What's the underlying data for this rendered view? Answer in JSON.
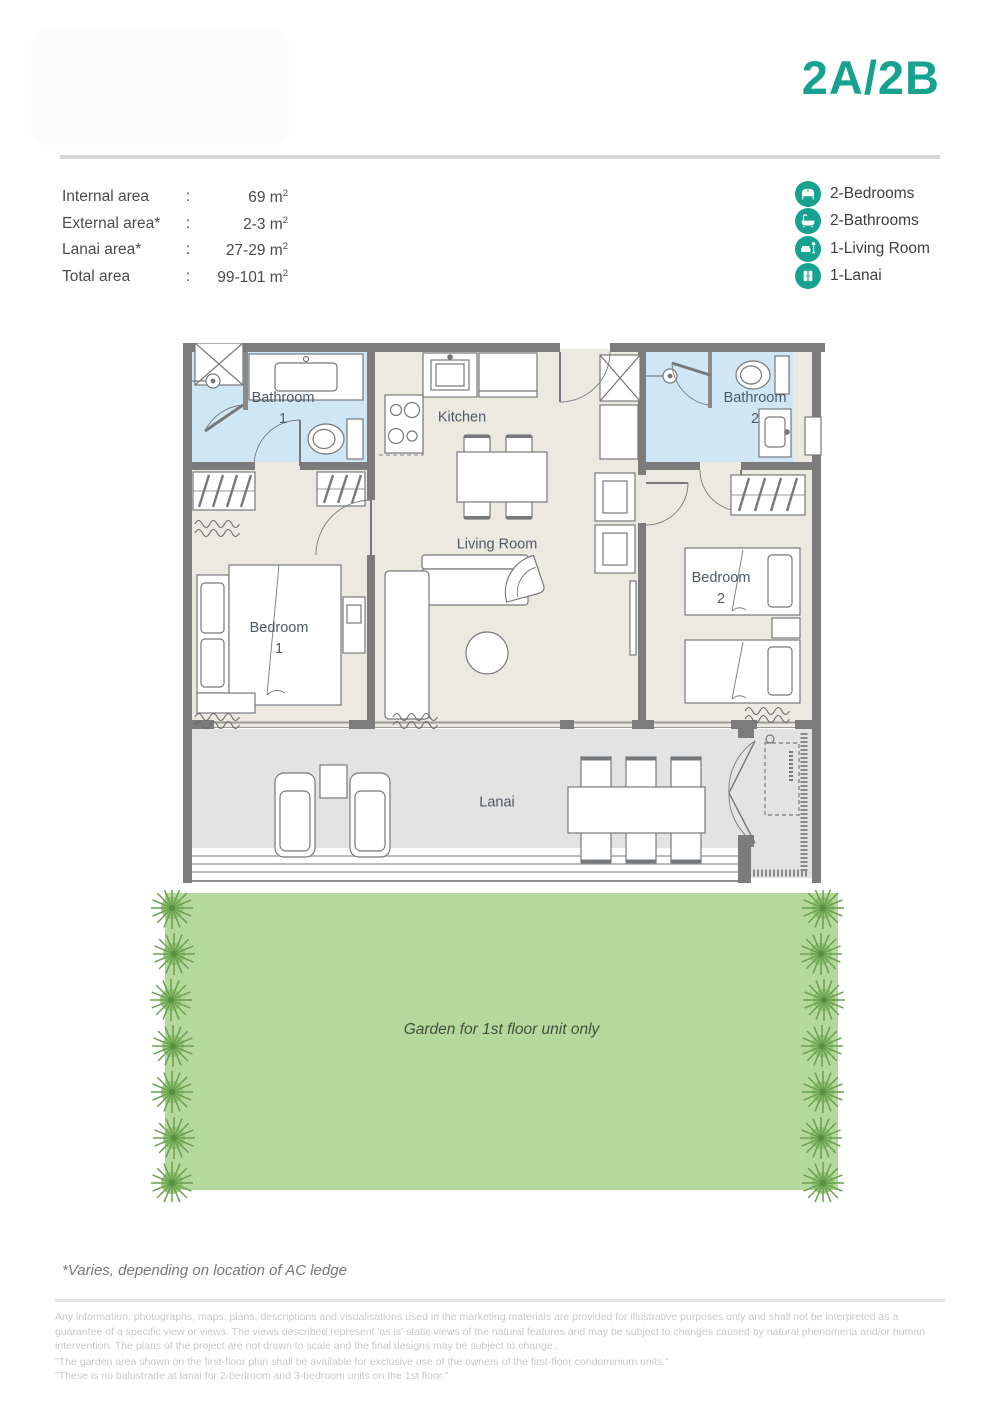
{
  "header": {
    "unit_label": "2A/2B"
  },
  "areas": {
    "colon": ":",
    "unit": "m",
    "sup": "2",
    "rows": [
      {
        "label": "Internal area",
        "value": "69"
      },
      {
        "label": "External area*",
        "value": "2-3"
      },
      {
        "label": "Lanai area*",
        "value": "27-29"
      },
      {
        "label": "Total area",
        "value": "99-101"
      }
    ]
  },
  "legend": {
    "items": [
      {
        "icon": "bed-icon",
        "label": "2-Bedrooms"
      },
      {
        "icon": "bathtub-icon",
        "label": "2-Bathrooms"
      },
      {
        "icon": "sofa-icon",
        "label": "1-Living Room"
      },
      {
        "icon": "door-icon",
        "label": "1-Lanai"
      }
    ]
  },
  "plan": {
    "rooms": {
      "bathroom1": {
        "line1": "Bathroom",
        "line2": "1"
      },
      "kitchen": {
        "line1": "Kitchen"
      },
      "bathroom2": {
        "line1": "Bathroom",
        "line2": "2"
      },
      "bedroom1": {
        "line1": "Bedroom",
        "line2": "1"
      },
      "living": {
        "line1": "Living Room"
      },
      "bedroom2": {
        "line1": "Bedroom",
        "line2": "2"
      },
      "lanai": {
        "line1": "Lanai"
      }
    }
  },
  "garden": {
    "label": "Garden for 1st floor unit only"
  },
  "footnotes": {
    "varies": "*Varies, depending on location of AC ledge",
    "disclaimer": "Any information, photographs, maps, plans, descriptions and visualisations used in the marketing materials are provided for illustrative purposes only and shall not be interpreted as a guarantee of a specific view or views. The views described represent 'as is' static views of the natural features and may be subject to changes caused by natural phenomena and/or human intervention. The plans of the project are not drawn to scale and the final designs may be subject to change..",
    "quote1": "\"The garden area shown on the first-floor plan shall be available for exclusive use of the owners of the first-floor condominium units.\"",
    "quote2": "\"These is no balustrade at lanai for 2-bedroom and 3-bedroom units on the 1st floor.\""
  },
  "colors": {
    "accent": "#16a28f",
    "wall": "#7c7c7c",
    "floor": "#ece9e1",
    "bathroom": "#cfe7f4",
    "lanai": "#e3e3e4",
    "garden": "#b5d99d",
    "tree": "#6aa050"
  }
}
